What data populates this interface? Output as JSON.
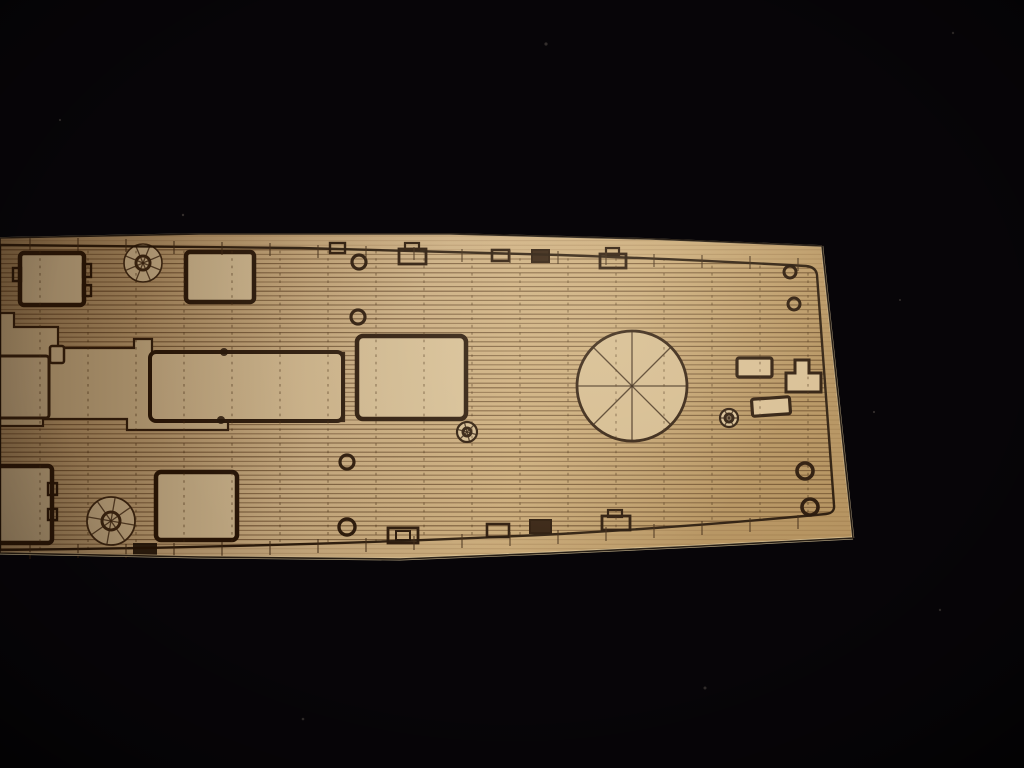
{
  "scene": {
    "description": "Photograph of a laser-cut and laser-etched light wooden model ship deck piece lying diagonally on a black fabric background. The deck plan is engraved with horizontal plank lines, dashed plank butt joints, hatch rectangles, two spoked capstans, a large spoked barbette circle, small ring fittings and edge chocks. The piece runs off the left edge of the photo; its bow end tapers at the right.",
    "background_color": "#070508",
    "wood_base_color": "#c9a87a",
    "etch_line_color": "#241204"
  },
  "canvas": {
    "width": 1024,
    "height": 768
  },
  "paths": {
    "wood": "M0,238 L200,234 L450,234 L650,239 L822,246 L853,538 L700,546 L550,553 L400,559 L200,557 L0,553 Z",
    "deck": "M0,245 L300,248 L560,255 Q700,260 806,266 Q816,267 817,275 L834,505 Q835,513 826,514 Q700,526 560,534 Q300,547 0,550 Z",
    "band": "M0,313 L14,313 L14,327 L58,327 L58,348 L134,348 L134,339 L152,339 L152,353 L344,353 L344,421 L228,421 L228,430 L127,430 L127,419 L43,419 L43,426 L0,426 Z",
    "tee": "M795,360 L809,360 L809,373 L821,373 L821,392 L786,392 L786,373 L795,373 Z",
    "rim_top": "M0,238 L200,234 L450,234 L650,239 L822,246",
    "rim_right": "M822,246 L853,538",
    "rim_bottom": "M853,538 L700,546 L550,553 L400,559 L200,557 L0,553"
  },
  "defs": {
    "clips": {
      "wood": "wood",
      "deck": "deck"
    },
    "gradients": [
      {
        "id": "woodGrad",
        "kind": "linear",
        "x1": 0,
        "y1": 0,
        "x2": 1,
        "y2": 0.25,
        "stops": [
          [
            0,
            "#a2835a",
            1
          ],
          [
            0.22,
            "#bf9e70",
            1
          ],
          [
            0.5,
            "#d0b285",
            1
          ],
          [
            0.75,
            "#c9a977",
            1
          ],
          [
            1,
            "#b3905c",
            1
          ]
        ]
      },
      {
        "id": "hiGrad",
        "kind": "radial",
        "cx": 0.58,
        "cy": 0.43,
        "r": 0.45,
        "stops": [
          [
            0,
            "#fff4d8",
            0.2
          ],
          [
            1,
            "#fff4d8",
            0
          ]
        ]
      },
      {
        "id": "leftShade",
        "kind": "linear",
        "x1": 0,
        "y1": 0,
        "x2": 1,
        "y2": 0,
        "stops": [
          [
            0,
            "#2c1808",
            0.42
          ],
          [
            0.3,
            "#2c1808",
            0.1
          ],
          [
            0.5,
            "#2c1808",
            0
          ]
        ]
      },
      {
        "id": "vig",
        "kind": "radial",
        "cx": 0.5,
        "cy": 0.44,
        "r": 0.75,
        "stops": [
          [
            0,
            "#000000",
            0
          ],
          [
            0.6,
            "#000000",
            0
          ],
          [
            0.82,
            "#000000",
            0.22
          ],
          [
            1,
            "#000000",
            0.65
          ]
        ]
      }
    ]
  },
  "layers": [
    {
      "name": "background",
      "type": "rect",
      "x": 0,
      "y": 0,
      "w": 1024,
      "h": 768,
      "fill": "#070508"
    },
    {
      "name": "dust-specks",
      "type": "dots",
      "fill": "#57504a",
      "o": 0.55,
      "pts": [
        [
          546,
          44,
          1.6
        ],
        [
          183,
          215,
          1.2
        ],
        [
          953,
          33,
          1.2
        ],
        [
          705,
          688,
          1.5
        ],
        [
          303,
          719,
          1.3
        ],
        [
          874,
          412,
          1.1
        ],
        [
          940,
          610,
          1.2
        ],
        [
          60,
          120,
          1.1
        ],
        [
          900,
          300,
          1.0
        ]
      ]
    },
    {
      "name": "wood-piece",
      "type": "path",
      "d": "wood",
      "fill": "url(#woodGrad)"
    },
    {
      "name": "wood-grain-faint",
      "type": "hlines",
      "y0": 236,
      "y1": 556,
      "step": 4.6,
      "x0": 0,
      "x1": 860,
      "color": "#6a4522",
      "w": 1,
      "ops": [
        0.2
      ],
      "clip": "wood"
    },
    {
      "name": "deck-planking",
      "type": "hlines",
      "y0": 236,
      "y1": 556,
      "step": 4.6,
      "x0": 0,
      "x1": 860,
      "color": "#4a2d12",
      "w": 1.05,
      "ops": [
        0.6,
        0.38,
        0.5
      ],
      "clip": "deck"
    },
    {
      "name": "superstructure-footprint",
      "type": "path",
      "d": "band",
      "fill": "#d2b88c",
      "stroke": "#2e1a0a",
      "sw": 2.2,
      "clip": "deck"
    },
    {
      "name": "hatch-left-edge",
      "type": "rect",
      "x": -8,
      "y": 356,
      "w": 57,
      "h": 62,
      "rx": 3,
      "fill": "#d6bd93",
      "stroke": "#2e1a0a",
      "sw": 3
    },
    {
      "name": "notch-fitting",
      "type": "rect",
      "x": 50,
      "y": 346,
      "w": 14,
      "h": 17,
      "rx": 2,
      "fill": "#d6bd93",
      "stroke": "#2e1a0a",
      "sw": 2.5
    },
    {
      "name": "deckhouse-hatch",
      "type": "rect",
      "x": 150,
      "y": 352,
      "w": 193,
      "h": 69,
      "rx": 6,
      "fill": "#d7bd92",
      "stroke": "#241204",
      "sw": 4
    },
    {
      "name": "hatch-fore-1",
      "type": "rect",
      "x": 20,
      "y": 253,
      "w": 64,
      "h": 52,
      "rx": 4,
      "fill": "#d8c096",
      "stroke": "#241204",
      "sw": 4.5
    },
    {
      "name": "hatch-fore-1-lug-left",
      "type": "rect",
      "x": 13,
      "y": 268,
      "w": 8,
      "h": 13,
      "stroke": "#241204",
      "sw": 2.4
    },
    {
      "name": "hatch-fore-1-lug-right-1",
      "type": "rect",
      "x": 83,
      "y": 264,
      "w": 8,
      "h": 13,
      "stroke": "#241204",
      "sw": 2.4
    },
    {
      "name": "hatch-fore-1-lug-right-2",
      "type": "rect",
      "x": 83,
      "y": 285,
      "w": 8,
      "h": 11,
      "stroke": "#241204",
      "sw": 2.4
    },
    {
      "name": "hatch-fore-2",
      "type": "rect",
      "x": 186,
      "y": 252,
      "w": 68,
      "h": 50,
      "rx": 4,
      "fill": "#d8c096",
      "stroke": "#241204",
      "sw": 4.5
    },
    {
      "name": "hatch-central",
      "type": "rect",
      "x": 357,
      "y": 336,
      "w": 109,
      "h": 83,
      "rx": 6,
      "fill": "#d9c197",
      "stroke": "#241204",
      "sw": 4.5
    },
    {
      "name": "hatch-aft-1",
      "type": "rect",
      "x": -8,
      "y": 466,
      "w": 60,
      "h": 77,
      "rx": 4,
      "fill": "#d8c096",
      "stroke": "#241204",
      "sw": 4.5
    },
    {
      "name": "hatch-aft-1-lug-1",
      "type": "rect",
      "x": 48,
      "y": 483,
      "w": 9,
      "h": 12,
      "stroke": "#241204",
      "sw": 2.4
    },
    {
      "name": "hatch-aft-1-lug-2",
      "type": "rect",
      "x": 48,
      "y": 509,
      "w": 9,
      "h": 11,
      "stroke": "#241204",
      "sw": 2.4
    },
    {
      "name": "hatch-aft-2",
      "type": "rect",
      "x": 156,
      "y": 472,
      "w": 81,
      "h": 68,
      "rx": 5,
      "fill": "#d9c197",
      "stroke": "#241204",
      "sw": 4.5
    },
    {
      "name": "capstan-fore",
      "type": "wheel",
      "cx": 143,
      "cy": 263,
      "r": 19,
      "hub": 7,
      "spokes": 8,
      "rot": 22,
      "fill": "#d6bd93",
      "stroke": "#3a2410",
      "sw": 1.6
    },
    {
      "name": "capstan-aft",
      "type": "wheel",
      "cx": 111,
      "cy": 521,
      "r": 24,
      "hub": 9,
      "spokes": 8,
      "rot": 10,
      "fill": "#d6bd93",
      "stroke": "#3a2410",
      "sw": 1.8
    },
    {
      "name": "barbette-ring",
      "type": "wheel",
      "cx": 632,
      "cy": 386,
      "r": 55,
      "hub": 0,
      "spokes": 8,
      "rot": 0,
      "fill": "#d3b98d",
      "stroke": "#2a1708",
      "sw": 2.8
    },
    {
      "name": "spoked-fitting-1",
      "type": "wheel",
      "cx": 467,
      "cy": 432,
      "r": 10,
      "hub": 4,
      "spokes": 6,
      "rot": 15,
      "fill": "#d6bd93",
      "stroke": "#241204",
      "sw": 2.2
    },
    {
      "name": "spoked-fitting-2",
      "type": "wheel",
      "cx": 729,
      "cy": 418,
      "r": 9,
      "hub": 4,
      "spokes": 6,
      "rot": 0,
      "fill": "#d6bd93",
      "stroke": "#241204",
      "sw": 2.2
    },
    {
      "name": "ring-fore-1",
      "type": "ring",
      "cx": 359,
      "cy": 262,
      "r": 7,
      "stroke": "#241204",
      "sw": 3.2
    },
    {
      "name": "ring-fore-2",
      "type": "ring",
      "cx": 358,
      "cy": 317,
      "r": 7,
      "stroke": "#241204",
      "sw": 3.2
    },
    {
      "name": "ring-bow-1",
      "type": "ring",
      "cx": 790,
      "cy": 272,
      "r": 6,
      "stroke": "#241204",
      "sw": 3
    },
    {
      "name": "ring-bow-2",
      "type": "ring",
      "cx": 794,
      "cy": 304,
      "r": 6,
      "stroke": "#241204",
      "sw": 3
    },
    {
      "name": "ring-aft-1",
      "type": "ring",
      "cx": 347,
      "cy": 462,
      "r": 7,
      "stroke": "#241204",
      "sw": 3.2
    },
    {
      "name": "ring-aft-2",
      "type": "ring",
      "cx": 347,
      "cy": 527,
      "r": 8,
      "stroke": "#241204",
      "sw": 3.4
    },
    {
      "name": "ring-bow-3",
      "type": "ring",
      "cx": 805,
      "cy": 471,
      "r": 8,
      "stroke": "#241204",
      "sw": 3.6
    },
    {
      "name": "ring-bow-4",
      "type": "ring",
      "cx": 810,
      "cy": 507,
      "r": 8,
      "stroke": "#241204",
      "sw": 3.6
    },
    {
      "name": "edge-fitting-t0",
      "type": "rect",
      "x": 330,
      "y": 243,
      "w": 15,
      "h": 10,
      "stroke": "#241204",
      "sw": 2.4
    },
    {
      "name": "edge-fitting-t1",
      "type": "rect",
      "x": 399,
      "y": 249,
      "w": 27,
      "h": 15,
      "stroke": "#241204",
      "sw": 2.8
    },
    {
      "name": "edge-fitting-t1-tab",
      "type": "rect",
      "x": 405,
      "y": 243,
      "w": 14,
      "h": 7,
      "stroke": "#241204",
      "sw": 2.2
    },
    {
      "name": "edge-fitting-t2",
      "type": "rect",
      "x": 492,
      "y": 250,
      "w": 17,
      "h": 11,
      "stroke": "#241204",
      "sw": 2.6
    },
    {
      "name": "edge-fitting-t3",
      "type": "rect",
      "x": 532,
      "y": 250,
      "w": 17,
      "h": 12,
      "fill": "#2e1a0a",
      "stroke": "#241204",
      "sw": 2
    },
    {
      "name": "edge-fitting-t4",
      "type": "rect",
      "x": 600,
      "y": 254,
      "w": 26,
      "h": 14,
      "stroke": "#241204",
      "sw": 2.8
    },
    {
      "name": "edge-fitting-t4-tab",
      "type": "rect",
      "x": 606,
      "y": 248,
      "w": 13,
      "h": 7,
      "stroke": "#241204",
      "sw": 2.2
    },
    {
      "name": "bow-fitting-rect-1",
      "type": "rect",
      "x": 737,
      "y": 358,
      "w": 35,
      "h": 19,
      "rx": 2,
      "fill": "#d7bd92",
      "stroke": "#241204",
      "sw": 3.2
    },
    {
      "name": "bow-fitting-rect-2",
      "type": "rect",
      "x": 752,
      "y": 398,
      "w": 38,
      "h": 17,
      "rx": 2,
      "rot": -4,
      "fill": "#d7bd92",
      "stroke": "#241204",
      "sw": 3.2
    },
    {
      "name": "bow-fitting-tee",
      "type": "path",
      "d": "tee",
      "fill": "#d7bd92",
      "stroke": "#241204",
      "sw": 3
    },
    {
      "name": "edge-notch",
      "type": "rect",
      "x": 133,
      "y": 543,
      "w": 24,
      "h": 12,
      "fill": "#140a02",
      "o": 0.9
    },
    {
      "name": "edge-fitting-b1",
      "type": "rect",
      "x": 388,
      "y": 528,
      "w": 30,
      "h": 15,
      "stroke": "#241204",
      "sw": 2.8
    },
    {
      "name": "edge-fitting-b1-inner",
      "type": "rect",
      "x": 396,
      "y": 531,
      "w": 14,
      "h": 9,
      "stroke": "#241204",
      "sw": 2
    },
    {
      "name": "edge-fitting-b2",
      "type": "rect",
      "x": 487,
      "y": 524,
      "w": 22,
      "h": 13,
      "stroke": "#241204",
      "sw": 2.6
    },
    {
      "name": "edge-fitting-b3",
      "type": "rect",
      "x": 530,
      "y": 520,
      "w": 21,
      "h": 13,
      "fill": "#2e1a0a",
      "stroke": "#241204",
      "sw": 2
    },
    {
      "name": "edge-fitting-b4",
      "type": "rect",
      "x": 602,
      "y": 516,
      "w": 28,
      "h": 14,
      "stroke": "#241204",
      "sw": 2.8
    },
    {
      "name": "edge-fitting-b4-tab",
      "type": "rect",
      "x": 608,
      "y": 510,
      "w": 14,
      "h": 7,
      "stroke": "#241204",
      "sw": 2.2
    },
    {
      "name": "burn-marks",
      "type": "dots",
      "fill": "#1e0f04",
      "o": 0.85,
      "pts": [
        [
          224,
          352,
          4
        ],
        [
          221,
          420,
          4
        ]
      ]
    },
    {
      "name": "plank-butt-lines",
      "type": "vdashes",
      "xs": [
        40,
        88,
        136,
        184,
        232,
        280,
        328,
        376,
        424,
        472,
        520,
        568,
        616,
        664,
        712,
        760,
        808
      ],
      "y0": 236,
      "y1": 556,
      "color": "#42280f",
      "w": 1.2,
      "dash": "2.6 4.8",
      "o": 0.5,
      "clip": "deck"
    },
    {
      "name": "deck-outline",
      "type": "path",
      "d": "deck",
      "stroke": "#1f1003",
      "sw": 2.4,
      "o": 0.95
    },
    {
      "name": "station-ticks-top",
      "type": "ticks",
      "up": 9,
      "down": 4,
      "color": "#3a2410",
      "w": 1.2,
      "o": 0.8,
      "pts": [
        [
          30,
          246
        ],
        [
          78,
          247
        ],
        [
          126,
          248
        ],
        [
          174,
          250
        ],
        [
          222,
          251
        ],
        [
          270,
          252
        ],
        [
          318,
          254
        ],
        [
          366,
          255
        ],
        [
          414,
          256
        ],
        [
          462,
          258
        ],
        [
          510,
          259
        ],
        [
          558,
          260
        ],
        [
          606,
          261
        ],
        [
          654,
          263
        ],
        [
          702,
          264
        ],
        [
          750,
          265
        ],
        [
          798,
          267
        ]
      ]
    },
    {
      "name": "station-ticks-bottom",
      "type": "ticks",
      "up": 4,
      "down": 10,
      "color": "#3a2410",
      "w": 1.2,
      "o": 0.8,
      "pts": [
        [
          30,
          549
        ],
        [
          78,
          548
        ],
        [
          126,
          548
        ],
        [
          174,
          547
        ],
        [
          222,
          546
        ],
        [
          270,
          545
        ],
        [
          318,
          543
        ],
        [
          366,
          542
        ],
        [
          414,
          540
        ],
        [
          462,
          538
        ],
        [
          510,
          536
        ],
        [
          558,
          534
        ],
        [
          606,
          531
        ],
        [
          654,
          528
        ],
        [
          702,
          525
        ],
        [
          750,
          522
        ],
        [
          798,
          519
        ]
      ]
    },
    {
      "name": "wood-edge-top-rim",
      "type": "path",
      "d": "rim_top",
      "stroke": "#ecd9b0",
      "sw": 1.8,
      "o": 0.6
    },
    {
      "name": "wood-edge-right-rim",
      "type": "path",
      "d": "rim_right",
      "stroke": "#e6d2a8",
      "sw": 2.5,
      "o": 0.75
    },
    {
      "name": "wood-edge-bottom-rim",
      "type": "path",
      "d": "rim_bottom",
      "stroke": "#e2cda2",
      "sw": 3,
      "o": 0.75
    },
    {
      "name": "wood-outer-edge",
      "type": "path",
      "d": "wood",
      "stroke": "#120a03",
      "sw": 1.6,
      "o": 0.9
    },
    {
      "name": "left-shade",
      "type": "rect",
      "x": 0,
      "y": 0,
      "w": 1024,
      "h": 768,
      "fill": "url(#leftShade)",
      "clip": "wood"
    },
    {
      "name": "center-highlight",
      "type": "rect",
      "x": 0,
      "y": 0,
      "w": 1024,
      "h": 768,
      "fill": "url(#hiGrad)",
      "clip": "wood"
    },
    {
      "name": "vignette",
      "type": "rect",
      "x": 0,
      "y": 0,
      "w": 1024,
      "h": 768,
      "fill": "url(#vig)"
    }
  ]
}
